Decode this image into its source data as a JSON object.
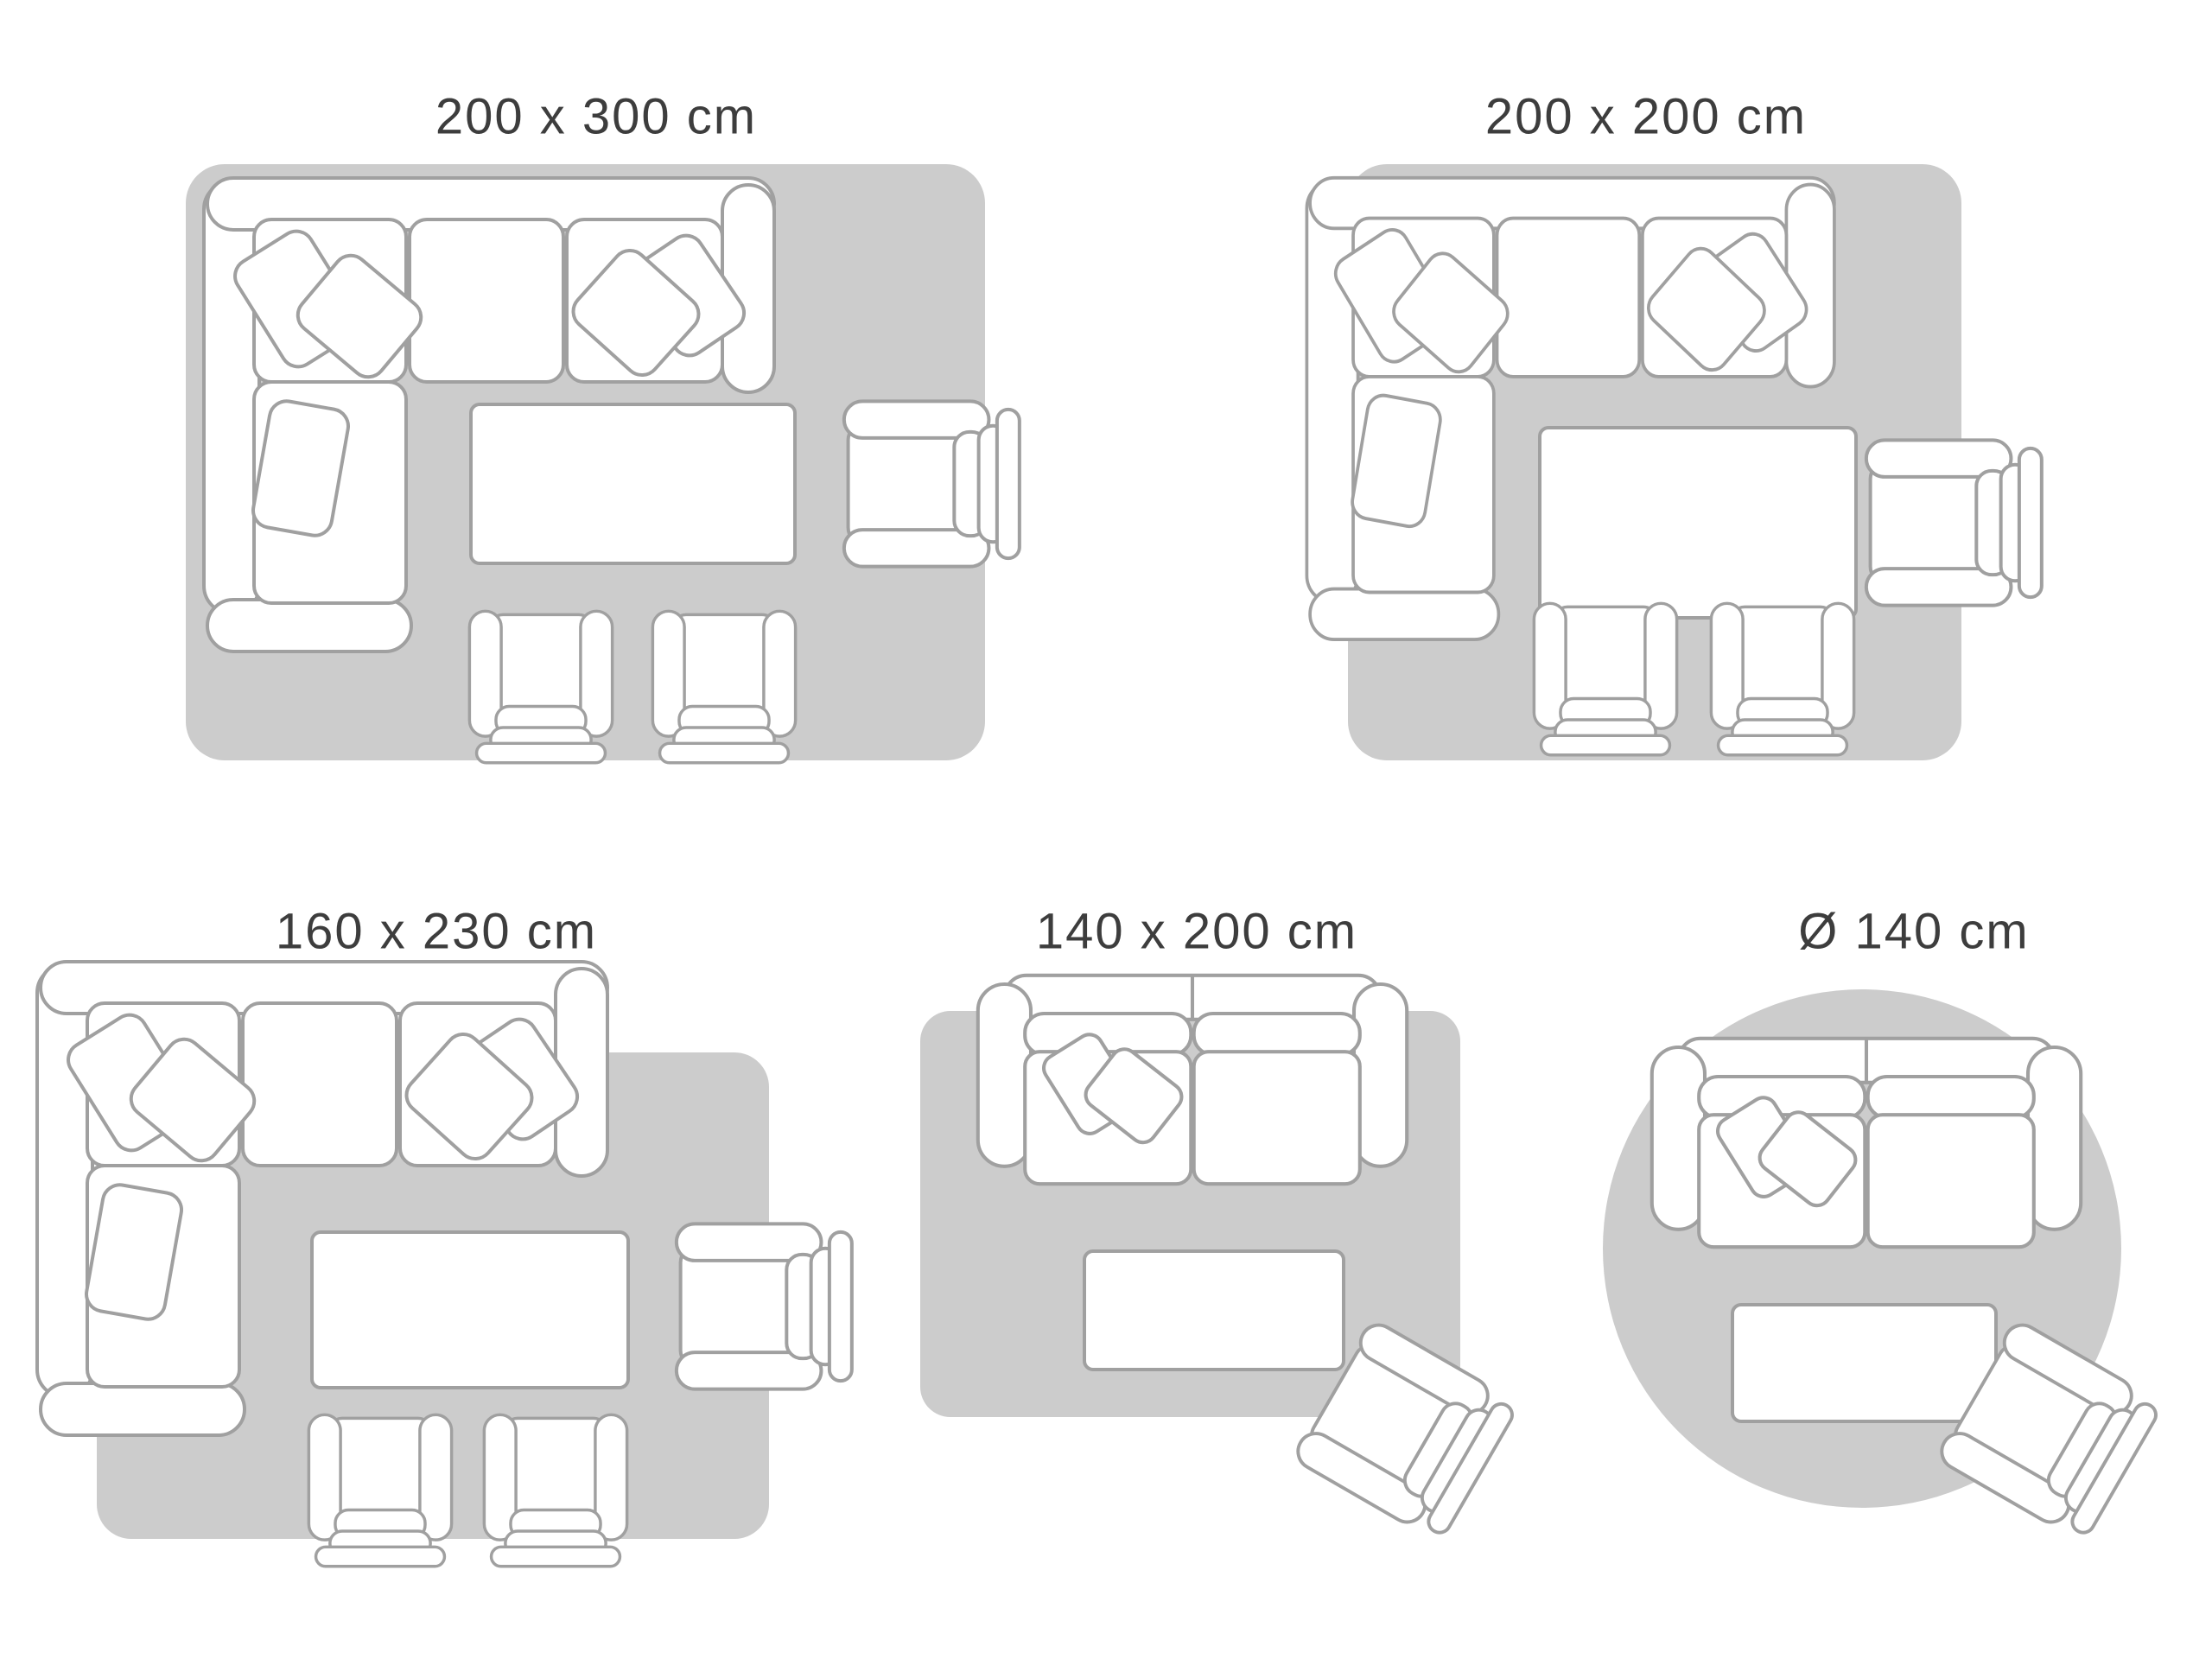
{
  "colors": {
    "background": "#ffffff",
    "rug": "#cccccc",
    "furniture_fill": "#ffffff",
    "furniture_stroke": "#a0a0a0",
    "title_text": "#3d3d3d"
  },
  "panels": [
    {
      "id": "rug-200x300",
      "label": "200 x 300 cm",
      "rug_shape": "rectangle",
      "furniture": [
        "corner-sofa-with-cushions",
        "coffee-table",
        "armchair",
        "armchair",
        "armchair"
      ]
    },
    {
      "id": "rug-200x200",
      "label": "200 x 200 cm",
      "rug_shape": "rectangle",
      "furniture": [
        "corner-sofa-with-cushions",
        "coffee-table",
        "armchair",
        "armchair",
        "armchair"
      ]
    },
    {
      "id": "rug-160x230",
      "label": "160 x 230 cm",
      "rug_shape": "rectangle",
      "furniture": [
        "corner-sofa-with-cushions",
        "coffee-table",
        "armchair",
        "armchair",
        "armchair"
      ]
    },
    {
      "id": "rug-140x200",
      "label": "140 x 200 cm",
      "rug_shape": "rectangle",
      "furniture": [
        "two-seater-sofa-with-cushions",
        "coffee-table",
        "armchair-diagonal"
      ]
    },
    {
      "id": "rug-d140",
      "label": "Ø 140 cm",
      "rug_shape": "circle",
      "furniture": [
        "two-seater-sofa-with-cushions",
        "coffee-table",
        "armchair-diagonal"
      ]
    }
  ]
}
